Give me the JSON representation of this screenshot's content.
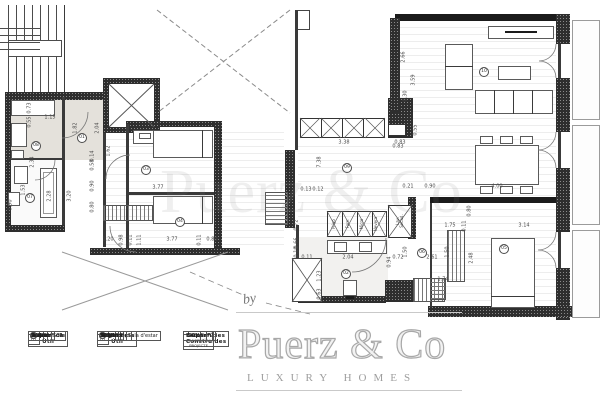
{
  "watermark": {
    "by": "by",
    "brand": "Puerz & Co",
    "tagline": "LUXURY HOMES",
    "center": "Puerz & Co"
  },
  "tables": [
    {
      "title": "Superficie Útil",
      "col": "P 01",
      "rows": [
        {
          "n": "01",
          "label": "Hall",
          "value": "2.84m²"
        },
        {
          "n": "02",
          "label": "Cuina",
          "value": "17.10m²"
        },
        {
          "n": "03",
          "label": "Dormitori 01",
          "value": "12.13m²"
        },
        {
          "n": "04",
          "label": "Dormitori 02",
          "value": "7.88m²"
        },
        {
          "n": "05",
          "label": "Suit",
          "value": "10.63m²"
        },
        {
          "n": "06",
          "label": "Vestidor Suit",
          "value": "2.25m²"
        }
      ]
    },
    {
      "title": "Superficie Útil",
      "col": "P 01",
      "rows": [
        {
          "n": "07",
          "label": "Bany Suit",
          "value": "5.81m²"
        },
        {
          "n": "08",
          "label": "Bany",
          "value": "3.00m²"
        },
        {
          "n": "09",
          "label": "Distribuïdor",
          "value": "11.34m²"
        },
        {
          "n": "10",
          "label": "Menjador / Sala d'estar",
          "value": "31.48m²"
        },
        {
          "n": "",
          "label": "TOTAL",
          "value": "101.38m²"
        }
      ]
    },
    {
      "title": "Superfícies Construïdes",
      "col": "Sup. CONSTRUÏDA PROJECTE",
      "rows": [
        {
          "n": "",
          "label": "Pis 2",
          "value": "121.15m²"
        },
        {
          "n": "",
          "label": "Balcons P2",
          "value": "7.40m²"
        }
      ]
    }
  ],
  "plan": {
    "markers": [
      {
        "n": "01",
        "x": 82,
        "y": 138
      },
      {
        "n": "08",
        "x": 36,
        "y": 146
      },
      {
        "n": "07",
        "x": 30,
        "y": 198
      },
      {
        "n": "03",
        "x": 146,
        "y": 170
      },
      {
        "n": "04",
        "x": 180,
        "y": 222
      },
      {
        "n": "09",
        "x": 347,
        "y": 168
      },
      {
        "n": "10",
        "x": 484,
        "y": 72
      },
      {
        "n": "02",
        "x": 346,
        "y": 274
      },
      {
        "n": "05",
        "x": 504,
        "y": 249
      },
      {
        "n": "06",
        "x": 422,
        "y": 253
      }
    ],
    "dimensions": [
      {
        "t": "0.73",
        "x": 30,
        "y": 108,
        "v": true
      },
      {
        "t": "0.55",
        "x": 30,
        "y": 122,
        "v": true
      },
      {
        "t": "2.34",
        "x": 33,
        "y": 162,
        "v": true
      },
      {
        "t": "1.15",
        "x": 50,
        "y": 118
      },
      {
        "t": "1.53",
        "x": 24,
        "y": 190,
        "v": true
      },
      {
        "t": "2.28",
        "x": 50,
        "y": 196,
        "v": true
      },
      {
        "t": "0.90",
        "x": 11,
        "y": 205,
        "v": true
      },
      {
        "t": "1.82",
        "x": 76,
        "y": 128,
        "v": true
      },
      {
        "t": "2.04",
        "x": 98,
        "y": 128,
        "v": true
      },
      {
        "t": "1.62",
        "x": 109,
        "y": 151,
        "v": true
      },
      {
        "t": "0.14",
        "x": 93,
        "y": 156,
        "v": true
      },
      {
        "t": "0.58",
        "x": 93,
        "y": 165,
        "v": true
      },
      {
        "t": "0.90",
        "x": 93,
        "y": 186,
        "v": true
      },
      {
        "t": "0.80",
        "x": 93,
        "y": 207,
        "v": true
      },
      {
        "t": "3.20",
        "x": 70,
        "y": 196,
        "v": true
      },
      {
        "t": "3.77",
        "x": 158,
        "y": 188
      },
      {
        "t": "1.20",
        "x": 108,
        "y": 240
      },
      {
        "t": "0.98",
        "x": 122,
        "y": 240,
        "v": true
      },
      {
        "t": "0.11",
        "x": 131,
        "y": 240,
        "v": true
      },
      {
        "t": "1.11",
        "x": 140,
        "y": 240,
        "v": true
      },
      {
        "t": "3.77",
        "x": 172,
        "y": 240
      },
      {
        "t": "0.11",
        "x": 200,
        "y": 240,
        "v": true
      },
      {
        "t": "0.80",
        "x": 212,
        "y": 240
      },
      {
        "t": "3.38",
        "x": 344,
        "y": 143
      },
      {
        "t": "0.83",
        "x": 400,
        "y": 143
      },
      {
        "t": "7.38",
        "x": 320,
        "y": 162,
        "v": true
      },
      {
        "t": "0.13",
        "x": 306,
        "y": 190
      },
      {
        "t": "0.12",
        "x": 318,
        "y": 190
      },
      {
        "t": "0.21",
        "x": 408,
        "y": 187
      },
      {
        "t": "0.90",
        "x": 430,
        "y": 187
      },
      {
        "t": "4.00",
        "x": 497,
        "y": 187
      },
      {
        "t": "0.72",
        "x": 297,
        "y": 225,
        "v": true
      },
      {
        "t": "0.66",
        "x": 297,
        "y": 243,
        "v": true
      },
      {
        "t": "0.10",
        "x": 297,
        "y": 252,
        "v": true
      },
      {
        "t": "0.11",
        "x": 307,
        "y": 258
      },
      {
        "t": "2.04",
        "x": 348,
        "y": 258
      },
      {
        "t": "1.23",
        "x": 320,
        "y": 276,
        "v": true
      },
      {
        "t": "0.63",
        "x": 320,
        "y": 294,
        "v": true
      },
      {
        "t": "0.94",
        "x": 390,
        "y": 262,
        "v": true
      },
      {
        "t": "0.72",
        "x": 398,
        "y": 258
      },
      {
        "t": "1.50",
        "x": 406,
        "y": 252,
        "v": true
      },
      {
        "t": "2.61",
        "x": 432,
        "y": 258
      },
      {
        "t": "1.50",
        "x": 448,
        "y": 252,
        "v": true
      },
      {
        "t": "1.74",
        "x": 443,
        "y": 280
      },
      {
        "t": "1.75",
        "x": 450,
        "y": 226
      },
      {
        "t": "0.11",
        "x": 465,
        "y": 226,
        "v": true
      },
      {
        "t": "3.14",
        "x": 524,
        "y": 226
      },
      {
        "t": "0.80",
        "x": 470,
        "y": 211,
        "v": true
      },
      {
        "t": "2.48",
        "x": 472,
        "y": 258,
        "v": true
      },
      {
        "t": "2.66",
        "x": 404,
        "y": 57,
        "v": true
      },
      {
        "t": "3.59",
        "x": 414,
        "y": 80,
        "v": true
      },
      {
        "t": "0.30",
        "x": 406,
        "y": 96,
        "v": true
      },
      {
        "t": "0.55",
        "x": 416,
        "y": 130,
        "v": true
      },
      {
        "t": "0.83",
        "x": 398,
        "y": 147
      }
    ],
    "appliances": [
      {
        "t": "Frigo",
        "x": 334,
        "y": 224
      },
      {
        "t": "Forn",
        "x": 348,
        "y": 224
      },
      {
        "t": "Micro",
        "x": 362,
        "y": 224
      },
      {
        "t": "Nevera",
        "x": 376,
        "y": 224
      },
      {
        "t": "Lav.\nSecad.",
        "x": 400,
        "y": 221
      }
    ]
  }
}
